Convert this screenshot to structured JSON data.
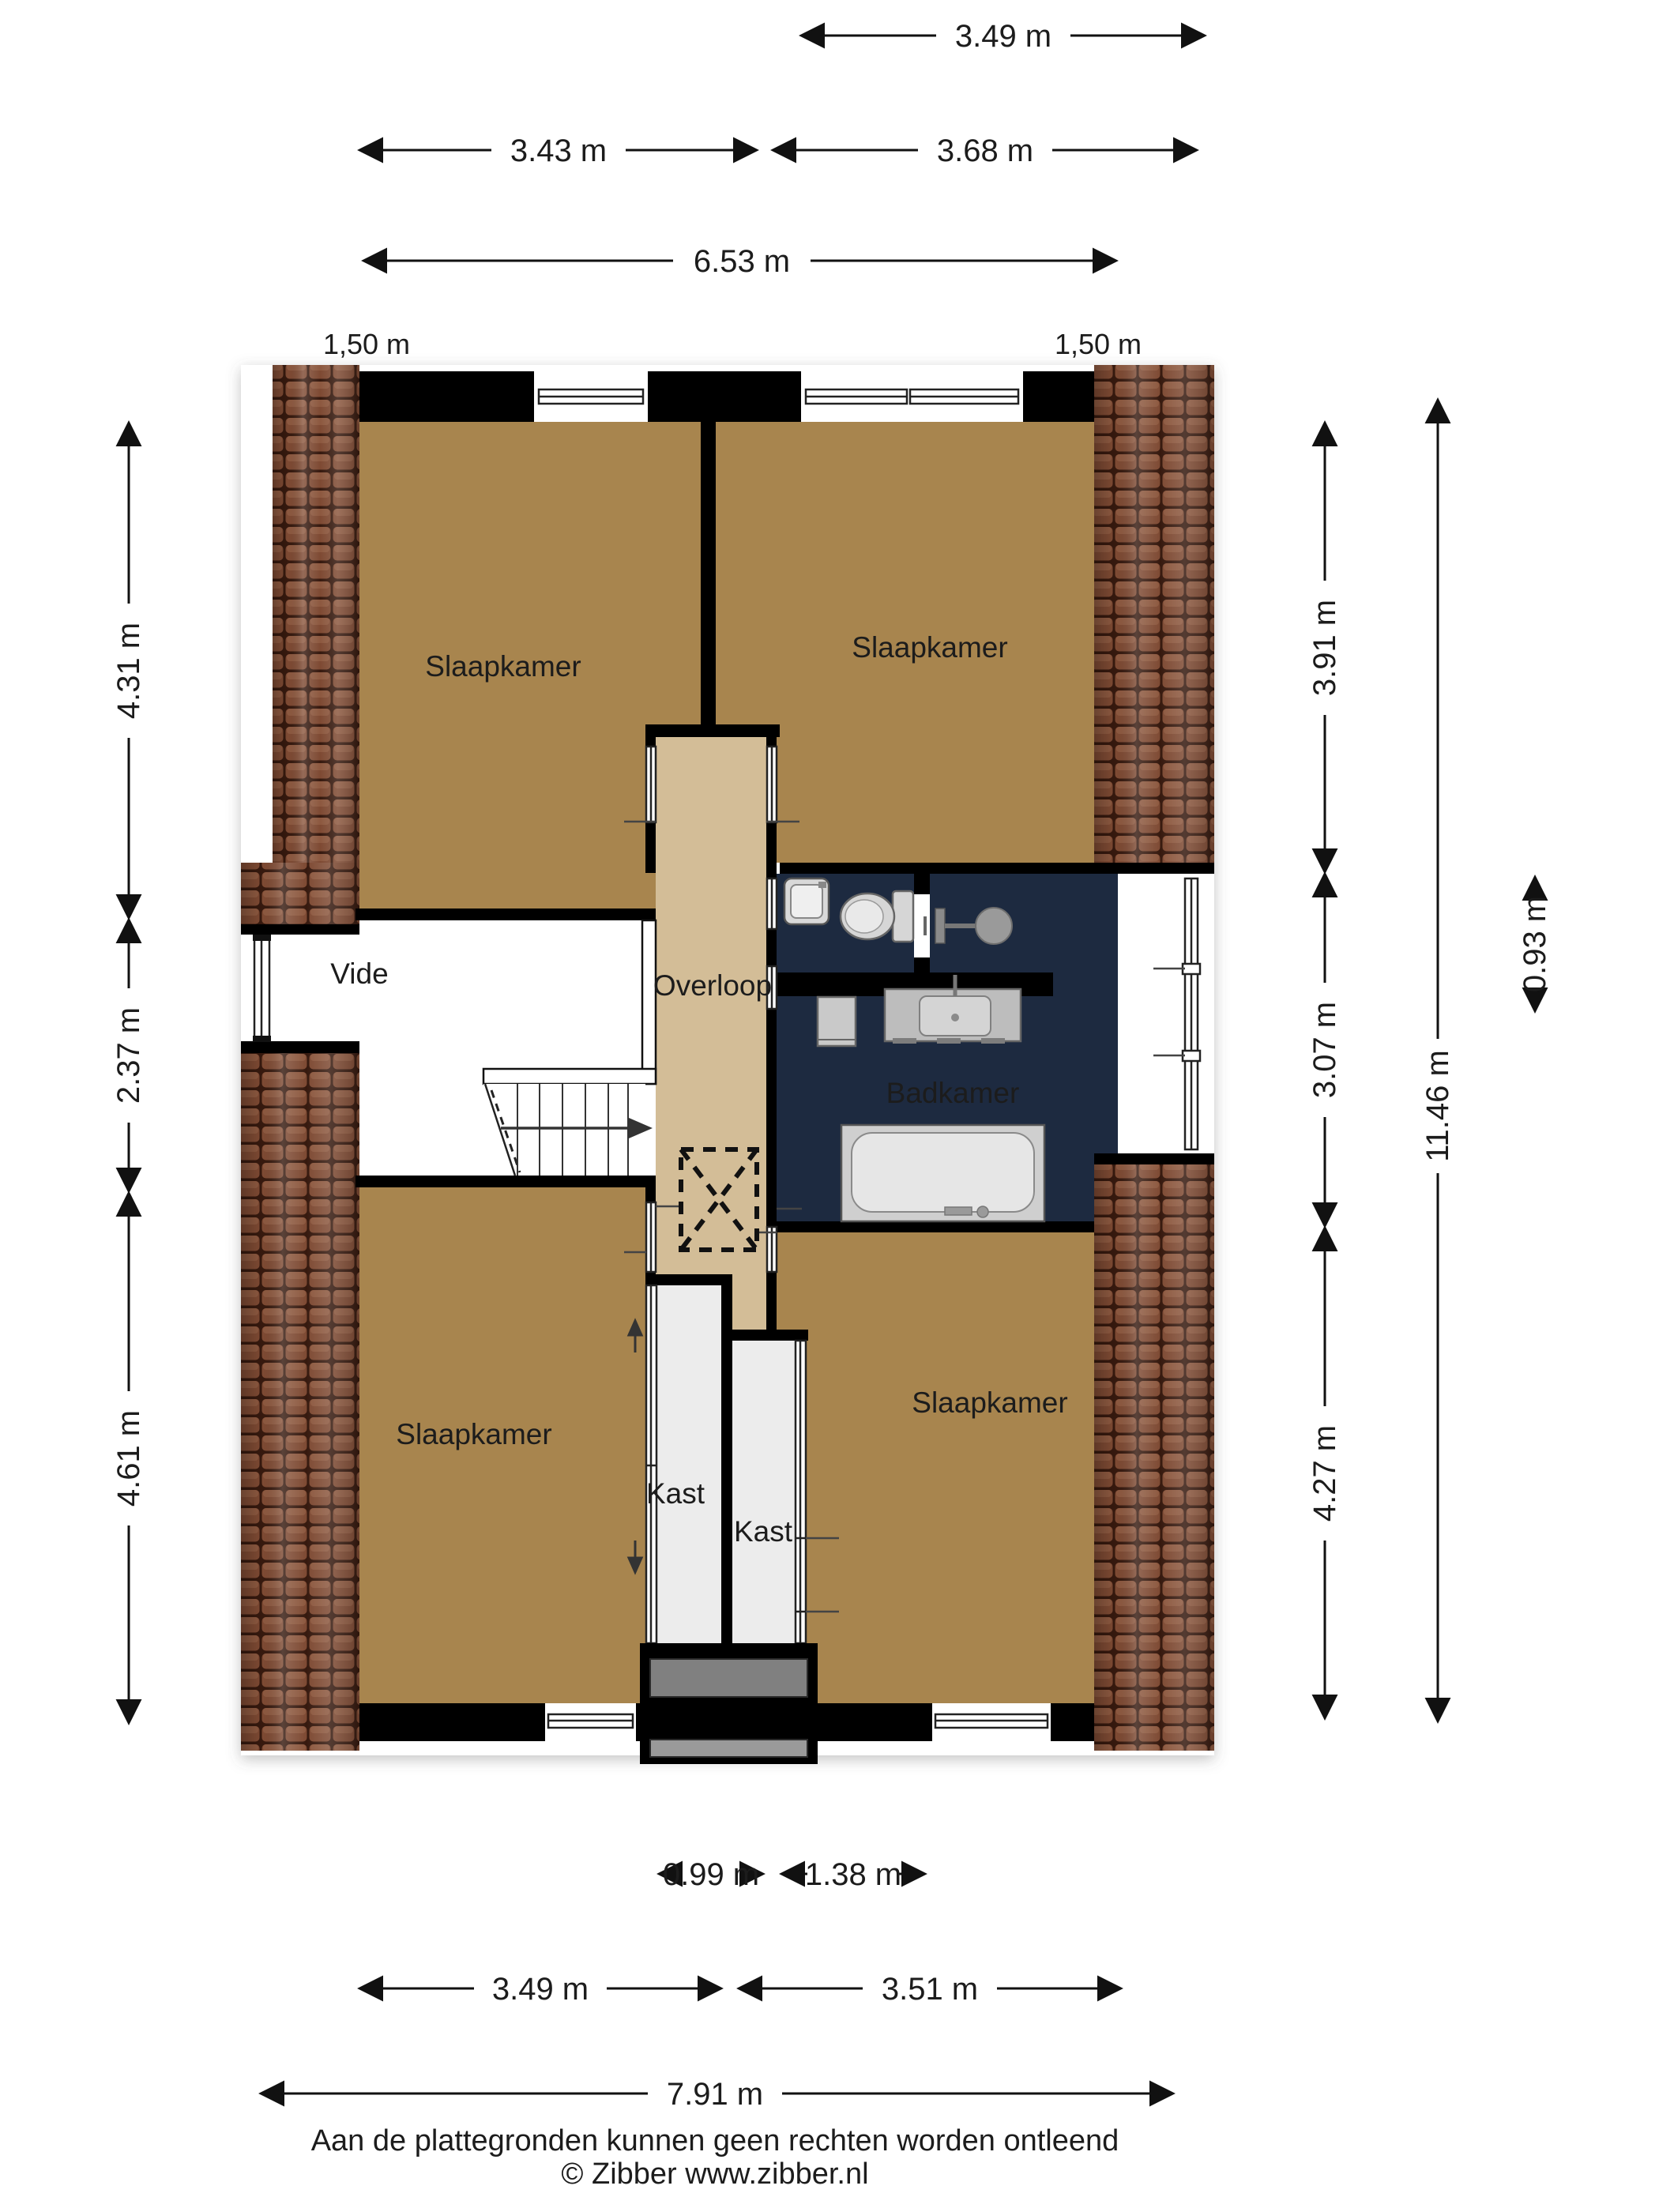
{
  "floorplan": {
    "rooms": {
      "bedroomTL": "Slaapkamer",
      "bedroomTR": "Slaapkamer",
      "bedroomBL": "Slaapkamer",
      "bedroomBR": "Slaapkamer",
      "vide": "Vide",
      "landing": "Overloop",
      "bathroom": "Badkamer",
      "closetL": "Kast",
      "closetR": "Kast"
    },
    "dims": {
      "t1": "3.49 m",
      "t2": "3.43 m",
      "t3": "3.68 m",
      "t4": "6.53 m",
      "eaveL": "1,50 m",
      "eaveR": "1,50 m",
      "l1": "4.31 m",
      "l2": "2.37 m",
      "l3": "4.61 m",
      "r1": "3.91 m",
      "r2": "3.07 m",
      "r3": "4.27 m",
      "rTotal": "11.46 m",
      "rSmall": "0.93 m",
      "b1": "0.99 m",
      "b2": "1.38 m",
      "b3": "3.49 m",
      "b4": "3.51 m",
      "b5": "7.91 m"
    },
    "footer": {
      "disclaimer": "Aan de plattegronden kunnen geen rechten worden ontleend",
      "credit": "© Zibber www.zibber.nl"
    },
    "colors": {
      "floor_bedroom": "#a8854e",
      "floor_landing": "#d3bd97",
      "floor_bathroom": "#1d2a40",
      "wall": "#000000",
      "tile_base": "#7e4a33",
      "closet_floor": "#ececec",
      "chimney_gray": "#808080"
    }
  }
}
